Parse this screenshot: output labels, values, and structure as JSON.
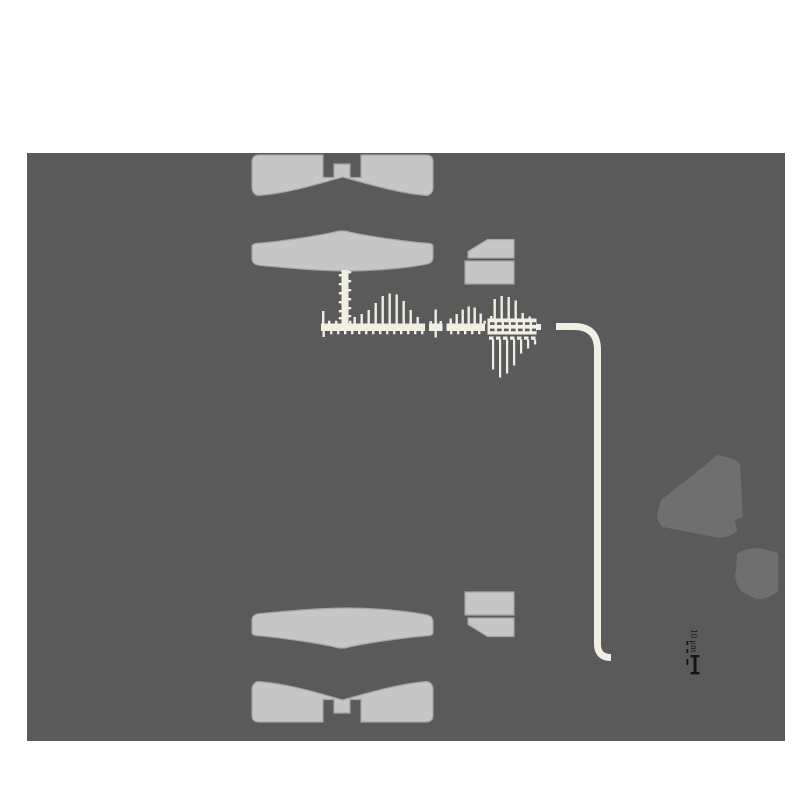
{
  "figure": {
    "colors": {
      "page-bg": "#ffffff",
      "panel": "#5a5a5a",
      "shape": "#c6c6c6",
      "shape-edge": "#a4a4a4",
      "blob": "#6f6f6f",
      "cream": "#f1efe3",
      "ink": "#141414"
    },
    "annotation": {
      "label": "10 μm"
    },
    "parts": [
      "upper-block-pair",
      "upper-lens-slab",
      "upper-side-box",
      "comb-probe-structure",
      "guide-line",
      "side-blob-large",
      "side-blob-small",
      "lower-lens-slab",
      "lower-block-pair",
      "lower-side-box",
      "scale-annotation"
    ]
  }
}
